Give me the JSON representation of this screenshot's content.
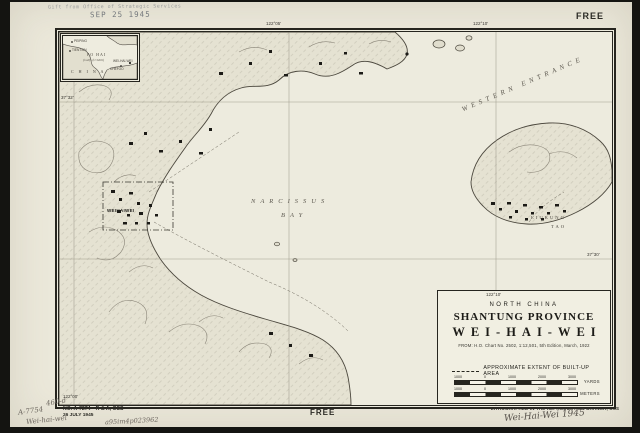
{
  "stamp": {
    "line1": "Gift from Office of Strategic Services",
    "line2": "SEP 25 1945"
  },
  "free_top": "FREE",
  "free_bottom": "FREE",
  "inset": {
    "sea": "PO HAI",
    "sea_sub": "(Gulf of Chihli)",
    "country": "C H I N A",
    "cities": {
      "peiping": "PEIPING",
      "tientsin": "TIENTSIN",
      "chefoo": "CHEFOO",
      "weihaiwei": "WEI-HAI-WEI"
    }
  },
  "graticule": {
    "m1": "122°00'",
    "m2": "122°05'",
    "m3": "122°10'",
    "block_tick": "122°10'",
    "lat_left": "37°32'",
    "lat_right": "37°30'"
  },
  "map_labels": {
    "bay1": "NARCISSUS",
    "bay2": "BAY",
    "western_entrance": "WESTERN ENTRANCE",
    "city": "WEIHAIWEI",
    "island1": "LIUKUNG",
    "island2": "TAO"
  },
  "title_block": {
    "region": "NORTH CHINA",
    "province": "SHANTUNG PROVINCE",
    "title": "WEI-HAI-WEI",
    "source": "FROM: H.O. Chart No. 2502, 1:12,501, 5th Edition, March, 1922",
    "legend": "APPROXIMATE EXTENT OF BUILT-UP AREA",
    "yards_unit": "YARDS",
    "meters_unit": "METERS",
    "yards_ticks": [
      "1000",
      "0",
      "1000",
      "2000",
      "3000"
    ],
    "meters_ticks": [
      "1000",
      "0",
      "1000",
      "2000",
      "3000"
    ]
  },
  "footer": {
    "sheet_no": "NO. A-7274—R & A, OSS",
    "date": "26 JULY 1945",
    "litho": "LITHOGRAPHED IN THE REPRODUCTION BRANCH, OSS",
    "hw_right": "Wei-Hai-Wei 1945",
    "hw1": "460-d",
    "hw2": "A-7754",
    "hw3": "Wei-hai-wei",
    "hw4": "a95im4p023962"
  }
}
